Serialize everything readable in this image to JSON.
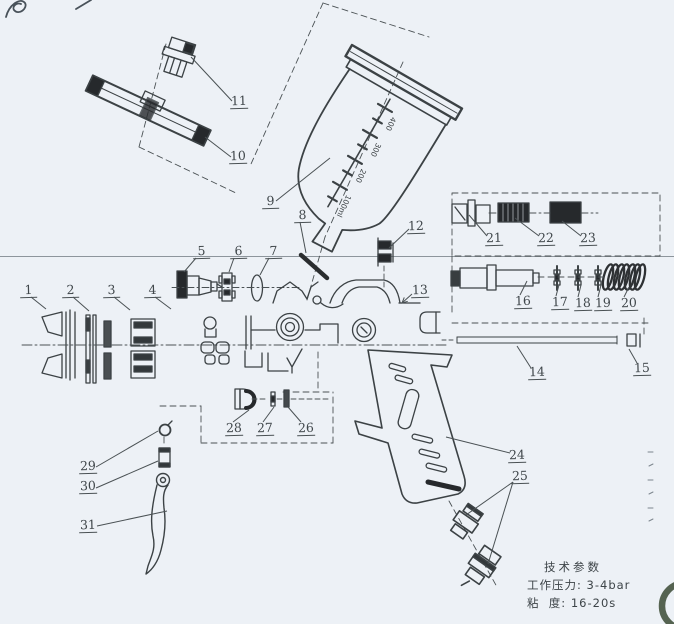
{
  "canvas": {
    "paper_color": "#edf1f6",
    "ink_color": "#3c4245",
    "dark_fill_color": "#26292c",
    "scanline_color": "#8d959c",
    "stamp_color": "#3a4a34",
    "description": "exploded parts diagram of a gravity-feed spray gun"
  },
  "callouts": [
    {
      "n": "1",
      "x": 20,
      "y": 283,
      "leaders": [
        [
          31,
          297,
          46,
          309
        ]
      ]
    },
    {
      "n": "2",
      "x": 62,
      "y": 283,
      "leaders": [
        [
          73,
          297,
          89,
          311
        ]
      ]
    },
    {
      "n": "3",
      "x": 103,
      "y": 283,
      "leaders": [
        [
          114,
          297,
          130,
          310
        ]
      ]
    },
    {
      "n": "4",
      "x": 144,
      "y": 283,
      "leaders": [
        [
          155,
          297,
          171,
          309
        ]
      ]
    },
    {
      "n": "5",
      "x": 193,
      "y": 244,
      "leaders": [
        [
          196,
          258,
          184,
          272
        ]
      ]
    },
    {
      "n": "6",
      "x": 230,
      "y": 244,
      "leaders": [
        [
          234,
          258,
          229,
          272
        ]
      ]
    },
    {
      "n": "7",
      "x": 265,
      "y": 244,
      "leaders": [
        [
          269,
          258,
          260,
          275
        ]
      ]
    },
    {
      "n": "8",
      "x": 294,
      "y": 208,
      "leaders": [
        [
          300,
          222,
          306,
          253
        ]
      ]
    },
    {
      "n": "9",
      "x": 262,
      "y": 194,
      "leaders": [
        [
          330,
          158,
          276,
          201
        ]
      ]
    },
    {
      "n": "10",
      "x": 229,
      "y": 149,
      "leaders": [
        [
          205,
          137,
          231,
          157
        ]
      ]
    },
    {
      "n": "11",
      "x": 230,
      "y": 94,
      "leaders": [
        [
          191,
          57,
          232,
          101
        ]
      ]
    },
    {
      "n": "12",
      "x": 407,
      "y": 219,
      "leaders": [
        [
          409,
          229,
          389,
          248
        ]
      ]
    },
    {
      "n": "13",
      "x": 411,
      "y": 283,
      "arrow": true,
      "leaders": [
        [
          412,
          294,
          402,
          303
        ]
      ]
    },
    {
      "n": "14",
      "x": 528,
      "y": 365,
      "leaders": [
        [
          517,
          346,
          531,
          368
        ]
      ]
    },
    {
      "n": "15",
      "x": 633,
      "y": 361,
      "leaders": [
        [
          629,
          349,
          637,
          363
        ]
      ]
    },
    {
      "n": "16",
      "x": 514,
      "y": 294,
      "leaders": [
        [
          527,
          281,
          520,
          295
        ]
      ]
    },
    {
      "n": "17",
      "x": 551,
      "y": 295,
      "leaders": [
        [
          559,
          285,
          556,
          296
        ]
      ]
    },
    {
      "n": "18",
      "x": 574,
      "y": 296,
      "leaders": [
        [
          581,
          285,
          578,
          297
        ]
      ]
    },
    {
      "n": "19",
      "x": 594,
      "y": 296,
      "leaders": [
        [
          601,
          285,
          598,
          297
        ]
      ]
    },
    {
      "n": "20",
      "x": 620,
      "y": 296,
      "leaders": [
        [
          629,
          287,
          624,
          297
        ]
      ]
    },
    {
      "n": "21",
      "x": 485,
      "y": 231,
      "leaders": [
        [
          469,
          215,
          487,
          236
        ]
      ]
    },
    {
      "n": "22",
      "x": 537,
      "y": 231,
      "leaders": [
        [
          515,
          218,
          539,
          236
        ]
      ]
    },
    {
      "n": "23",
      "x": 579,
      "y": 231,
      "leaders": [
        [
          562,
          221,
          581,
          236
        ]
      ]
    },
    {
      "n": "24",
      "x": 508,
      "y": 448,
      "leaders": [
        [
          446,
          437,
          510,
          453
        ]
      ]
    },
    {
      "n": "25",
      "x": 511,
      "y": 469,
      "leaders": [
        [
          513,
          482,
          466,
          515
        ],
        [
          513,
          482,
          488,
          564
        ]
      ]
    },
    {
      "n": "26",
      "x": 297,
      "y": 421,
      "leaders": [
        [
          288,
          407,
          301,
          422
        ]
      ]
    },
    {
      "n": "27",
      "x": 256,
      "y": 421,
      "leaders": [
        [
          274,
          407,
          263,
          422
        ]
      ]
    },
    {
      "n": "28",
      "x": 225,
      "y": 421,
      "leaders": [
        [
          249,
          410,
          233,
          422
        ]
      ]
    },
    {
      "n": "29",
      "x": 79,
      "y": 459,
      "leaders": [
        [
          96,
          467,
          158,
          431
        ]
      ]
    },
    {
      "n": "30",
      "x": 79,
      "y": 479,
      "leaders": [
        [
          96,
          488,
          158,
          461
        ]
      ]
    },
    {
      "n": "31",
      "x": 79,
      "y": 518,
      "leaders": [
        [
          97,
          526,
          167,
          511
        ]
      ]
    }
  ],
  "cup_scale": [
    "400",
    "300",
    "200",
    "100ml"
  ],
  "specs": {
    "title": "技术参数",
    "rows": [
      {
        "label": "工作压力:",
        "value": "3-4bar"
      },
      {
        "label": "粘  度:",
        "value": "16-20s"
      }
    ]
  }
}
